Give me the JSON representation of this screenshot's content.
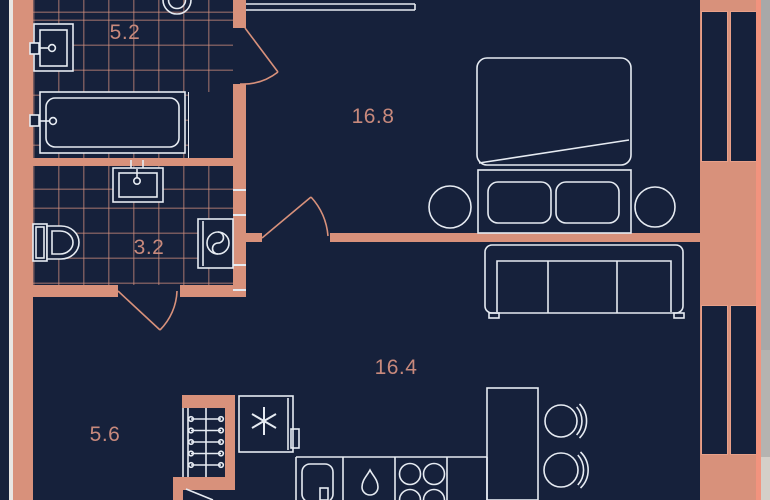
{
  "floor_plan": {
    "rooms": {
      "bathroom_large": {
        "area": "5.2"
      },
      "bedroom": {
        "area": "16.8"
      },
      "bathroom_small": {
        "area": "3.2"
      },
      "living_kitchen": {
        "area": "16.4"
      },
      "hallway": {
        "area": "5.6"
      }
    },
    "colors": {
      "background": "#16213b",
      "wall": "#d8917b",
      "wall_accent": "#f2937e",
      "furniture_line": "#e6ebf2",
      "tile_line": "rgba(213,146,127,0.5)",
      "room_label": "#c8897c",
      "outside_strip": "#a8a8a8"
    },
    "furniture_icons": [
      "ceiling-light",
      "washbasin",
      "bathtub",
      "toilet",
      "washing-machine",
      "double-bed",
      "pillows",
      "nightstands",
      "sofa",
      "wardrobe-hangers",
      "refrigerator",
      "snowflake",
      "kitchen-sink",
      "water-drop",
      "stove-burners",
      "dining-table",
      "chairs",
      "door-swings",
      "windows"
    ]
  }
}
